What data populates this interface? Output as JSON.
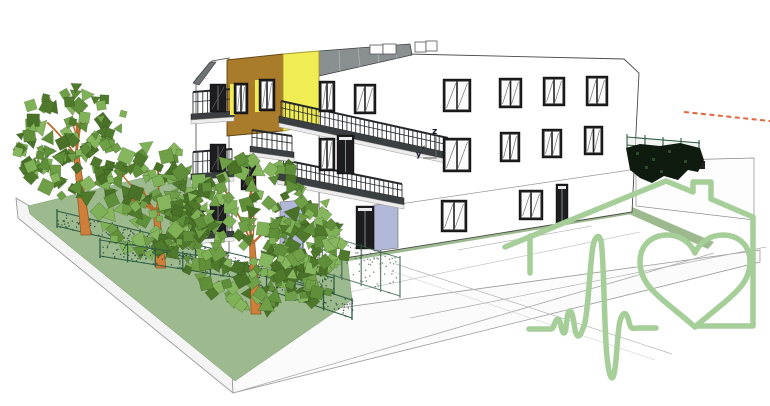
{
  "title": "3D architectural model - residential building with garden, trees and house-heart health logo overlay",
  "canvas": {
    "width": 770,
    "height": 406,
    "background": "#ffffff"
  },
  "axis_indicator": {
    "z_label": "z",
    "y_label": "y",
    "x_label": "x"
  },
  "colors": {
    "logo_green": "#a6ce98",
    "ochre": "#a87c2b",
    "yellow": "#f0ec54",
    "roof_gray": "#8a8f91",
    "gable_roof_gray": "#6e7476",
    "wall_white": "#ffffff",
    "window_frame": "#1d1d1f",
    "balcony_dark": "#3a3f41",
    "railing_dark": "#26292b",
    "ground_green": "#9cba8e",
    "trunk_orange": "#cf7f3a",
    "trunk_edge": "#8a5526",
    "branch": "#b96b2d",
    "fence_green": "#2f5c45",
    "hedge_dark": "#101b10",
    "lavender": "#b1b8d8",
    "dashed_line_orange": "#e0663f",
    "edge_gray": "#9a9a9a",
    "foliage": [
      "#4f7a2b",
      "#5f8f38",
      "#6fa047",
      "#7fb256",
      "#497128",
      "#86b75e"
    ]
  },
  "logo": {
    "name": "house-heart-heartbeat-logo",
    "elements": [
      "house outline with chimney",
      "heart",
      "ekg heartbeat line"
    ]
  },
  "scene": {
    "windows": [
      {
        "rect": [
          443,
          79,
          28,
          33
        ],
        "type": "std"
      },
      {
        "rect": [
          499,
          78,
          23,
          30
        ],
        "type": "std"
      },
      {
        "rect": [
          543,
          77,
          22,
          29
        ],
        "type": "std"
      },
      {
        "rect": [
          586,
          76,
          22,
          30
        ],
        "type": "std"
      },
      {
        "rect": [
          319,
          81,
          16,
          31
        ],
        "type": "std"
      },
      {
        "rect": [
          354,
          84,
          22,
          30
        ],
        "type": "std"
      },
      {
        "rect": [
          443,
          138,
          28,
          34
        ],
        "type": "std"
      },
      {
        "rect": [
          500,
          132,
          20,
          30
        ],
        "type": "std"
      },
      {
        "rect": [
          542,
          129,
          20,
          29
        ],
        "type": "std"
      },
      {
        "rect": [
          584,
          126,
          19,
          29
        ],
        "type": "std"
      },
      {
        "rect": [
          319,
          138,
          16,
          33
        ],
        "type": "std"
      },
      {
        "rect": [
          441,
          200,
          26,
          32
        ],
        "type": "std"
      },
      {
        "rect": [
          519,
          190,
          24,
          30
        ],
        "type": "std"
      },
      {
        "rect": [
          234,
          83,
          14,
          31
        ],
        "type": "reveal"
      },
      {
        "rect": [
          259,
          79,
          16,
          32
        ],
        "type": "reveal"
      },
      {
        "rect": [
          210,
          84,
          16,
          28
        ],
        "type": "dark"
      },
      {
        "rect": [
          210,
          144,
          16,
          28
        ],
        "type": "dark"
      },
      {
        "rect": [
          210,
          204,
          16,
          28
        ],
        "type": "dark"
      },
      {
        "rect": [
          241,
          160,
          15,
          30
        ],
        "type": "dark"
      },
      {
        "rect": [
          556,
          184,
          12,
          40
        ],
        "type": "door"
      },
      {
        "rect": [
          356,
          206,
          18,
          43
        ],
        "type": "door"
      },
      {
        "rect": [
          337,
          135,
          17,
          39
        ],
        "type": "door"
      }
    ],
    "balconies": [
      {
        "x1": 281,
        "y1": 101,
        "x2": 448,
        "y2": 138,
        "drop": 15,
        "slabH": 7
      },
      {
        "x1": 279,
        "y1": 159,
        "x2": 402,
        "y2": 184,
        "drop": 14,
        "slabH": 7
      },
      {
        "x1": 252,
        "y1": 130,
        "x2": 292,
        "y2": 136,
        "drop": 16,
        "slabH": 6
      },
      {
        "x1": 193,
        "y1": 92,
        "x2": 232,
        "y2": 89,
        "drop": 22,
        "slabH": 6
      },
      {
        "x1": 193,
        "y1": 152,
        "x2": 232,
        "y2": 149,
        "drop": 22,
        "slabH": 6
      },
      {
        "x1": 193,
        "y1": 212,
        "x2": 232,
        "y2": 209,
        "drop": 22,
        "slabH": 6
      }
    ],
    "trees": [
      {
        "layer": "trees-back",
        "trunk": [
          86,
          235
        ],
        "top": [
          76,
          152
        ],
        "canopy": [
          74,
          142
        ],
        "rx": 57,
        "ry": 58,
        "leaves": 110,
        "seed": 11
      },
      {
        "layer": "trees-back",
        "trunk": [
          161,
          268
        ],
        "top": [
          156,
          208
        ],
        "canopy": [
          156,
          200
        ],
        "rx": 60,
        "ry": 55,
        "leaves": 115,
        "seed": 23
      },
      {
        "layer": "trees-front",
        "trunk": [
          256,
          314
        ],
        "top": [
          252,
          240
        ],
        "canopy": [
          255,
          233
        ],
        "rx": 84,
        "ry": 76,
        "leaves": 190,
        "seed": 37
      },
      {
        "layer": "trees-front",
        "trunk": null,
        "canopy": [
          306,
          258
        ],
        "rx": 40,
        "ry": 44,
        "leaves": 70,
        "seed": 49
      }
    ],
    "fences": [
      {
        "layer": "fence-back",
        "a": [
          57,
          211
        ],
        "b": [
          334,
          278
        ],
        "h": 15,
        "posts": 11,
        "opacity": 1
      },
      {
        "layer": "fence-front",
        "a": [
          100,
          240
        ],
        "b": [
          238,
          262
        ],
        "h": 16,
        "posts": 6,
        "opacity": 1
      },
      {
        "layer": "fence-front",
        "a": [
          238,
          262
        ],
        "b": [
          352,
          300
        ],
        "h": 18,
        "posts": 5,
        "opacity": 1
      },
      {
        "layer": "fence-front",
        "a": [
          303,
          228
        ],
        "b": [
          400,
          258
        ],
        "h": 38,
        "posts": 6,
        "opacity": 0.75
      }
    ]
  }
}
